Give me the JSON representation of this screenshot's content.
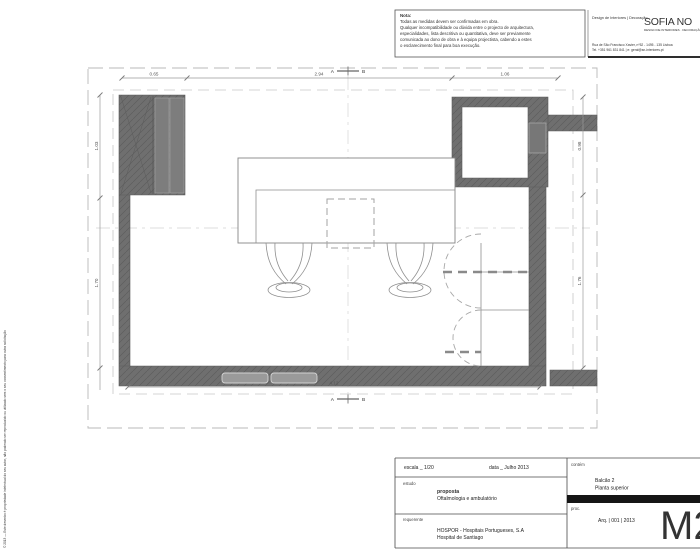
{
  "colors": {
    "wall_fill": "#6f6f6f",
    "wall_hatch": "#5e5e5e",
    "line_gray": "#8f8f8f",
    "dim_gray": "#9a9a9a",
    "text_dark": "#222222",
    "titlebar_black": "#151515"
  },
  "side_note": "© 2013 — Este desenho é propriedade intelectual do seu autor, não podendo ser reproduzido ou utilizado sem o seu consentimento para outra solicitação",
  "note": {
    "title": "Nota:",
    "lines": [
      "Todas as medidas devem ser confirmadas em obra.",
      "Qualquer incompatibilidade ou dúvida entre o projecto de arquitectura,",
      "especialidades, lista descritiva ou quantitativa, deve ser previamente",
      "comunicada ao dono de obra e  à  equipa projectista, cabendo a estes",
      "o esclarecimento final para boa execução."
    ]
  },
  "header": {
    "tagline": "Design de Interiores   |   Decoração",
    "logo": "SOFIA NO",
    "logo_sub": "DESIGN DE INTERIORES · DECORAÇÃO",
    "address_line1": "Rua de São Francisco Xavier, nº52 - 1495 - 135 Lisboa",
    "address_line2": "Tel. +351 961 831 841  |  e: geral@sn-interiores.pt"
  },
  "plan": {
    "dims": {
      "d065": "0.65",
      "d294": "2.94",
      "d106": "1.06",
      "d103": "1.03",
      "d170": "1.70",
      "d098": "0.98",
      "d176": "1.76",
      "d412": "4.12"
    },
    "section": {
      "a": "A",
      "b": "B"
    }
  },
  "titleblock": {
    "scale_label": "escala _ 1/20",
    "date_label": "data _ Julho 2013",
    "study_label": "estudo",
    "study_title": "proposta",
    "study_subtitle": "Oftalmologia e ambulatório",
    "client_label": "requerente",
    "client_name": "HOSPOR - Hospitais Portugueses, S.A",
    "client_site": "Hospital de Santiago",
    "contains_label": "contém",
    "contains_line1": "Balcão 2",
    "contains_line2": "Planta superior",
    "proc_label": "proc.",
    "proc_value": "Arq. | 001 | 2013",
    "sheet_code": "M2"
  }
}
